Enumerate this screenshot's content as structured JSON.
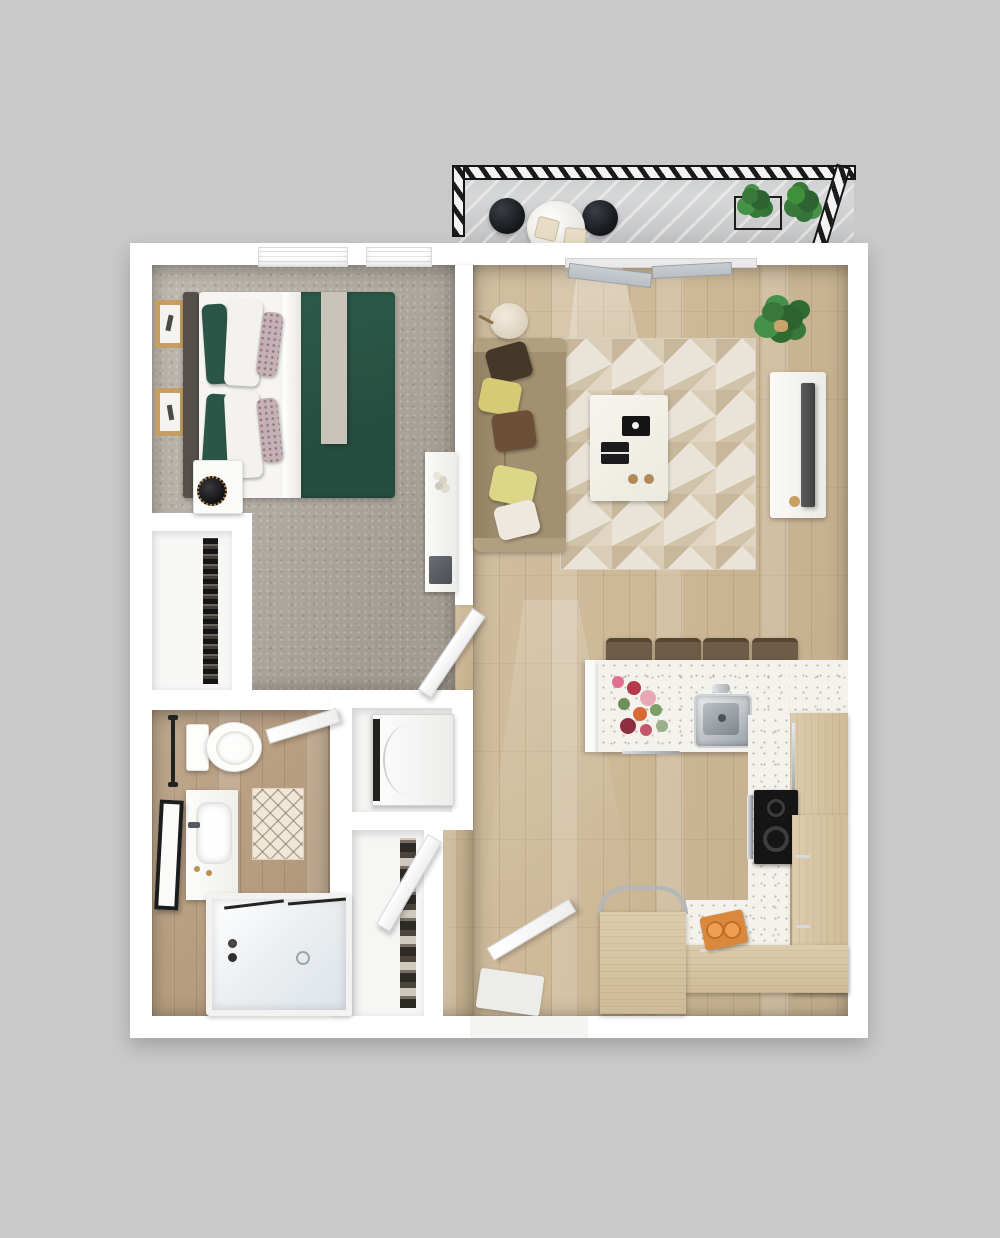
{
  "meta": {
    "title": "One-bedroom apartment 3D floor plan",
    "view": "top-down render",
    "visible_text": []
  },
  "colors": {
    "bg": "#c9c9c9",
    "wall": "#ffffff",
    "carpet": "#b4aea5",
    "wood": "#cdb897",
    "bathWood": "#b89e81",
    "balconyFloor": "#d6d7d8",
    "railing": "#1b1b1b",
    "rugBase": "#eae4d8",
    "rugA": "#c8b79a",
    "rugB": "#d9cdb6",
    "sofa": "#a29070",
    "pDark": "#463828",
    "pYellow": "#d6ca74",
    "pBrown": "#6b4f38",
    "pCream": "#eee8df",
    "bedGreen": "#2e5a4a",
    "bedGreenD": "#264d3f",
    "sheet": "#f6f5f1",
    "throwGray": "#c9c4ba",
    "floral": "#c5b0b6",
    "headboard": "#554f49",
    "frame": "#c79e62",
    "terrazzo": "#f4f2ec",
    "cabinet": "#d8c5a2",
    "stoolSeat": "#6e5c46",
    "stove": "#151515",
    "steel": "#b9bdc1",
    "plant": "#38783b",
    "plantD": "#2c6330",
    "tv": "#4d4d4d",
    "gold": "#b9904f",
    "glass": "#b9bfc4"
  },
  "rooms": {
    "balcony": {
      "name": "Balcony",
      "furniture": [
        "bistro table",
        "two black stools",
        "seat cushions",
        "wire planter with two green plants",
        "hatched metal railing"
      ]
    },
    "bedroom": {
      "name": "Bedroom",
      "furniture": [
        "queen bed with green duvet",
        "gray headboard",
        "green and white and floral pillows",
        "gray throw blanket",
        "white nightstand",
        "black round speaker",
        "two framed wall art pieces",
        "wardrobe closet with hanging clothes",
        "white desk with laptop",
        "two windows with blinds",
        "swing door"
      ]
    },
    "living_room": {
      "name": "Living Room",
      "furniture": [
        "tan sofa with five throw pillows",
        "geometric triangle rug",
        "white coffee table with black tray and book and two coasters",
        "floor lamp",
        "white media console",
        "flat tv panel",
        "potted fiddle plant",
        "sliding balcony door"
      ]
    },
    "kitchen": {
      "name": "Kitchen",
      "furniture": [
        "terrazzo breakfast bar",
        "four wood bar stools",
        "stainless sink with faucet",
        "flower bouquet",
        "towel rail",
        "wood refrigerator cabinet",
        "black two-burner cooktop",
        "L-shaped wood counter",
        "dishwasher with chrome handle",
        "cutting board with orange slices"
      ]
    },
    "bathroom": {
      "name": "Bathroom",
      "furniture": [
        "toilet",
        "towel bar",
        "vanity with sink and gold hardware",
        "black leaning mirror",
        "lattice bath mat",
        "tub shower with glass panel",
        "swing door"
      ]
    },
    "hall": {
      "name": "Hall / Entry",
      "furniture": [
        "washer-dryer closet",
        "linen closet with shelves",
        "closet door",
        "entry door",
        "entry mat"
      ]
    }
  }
}
